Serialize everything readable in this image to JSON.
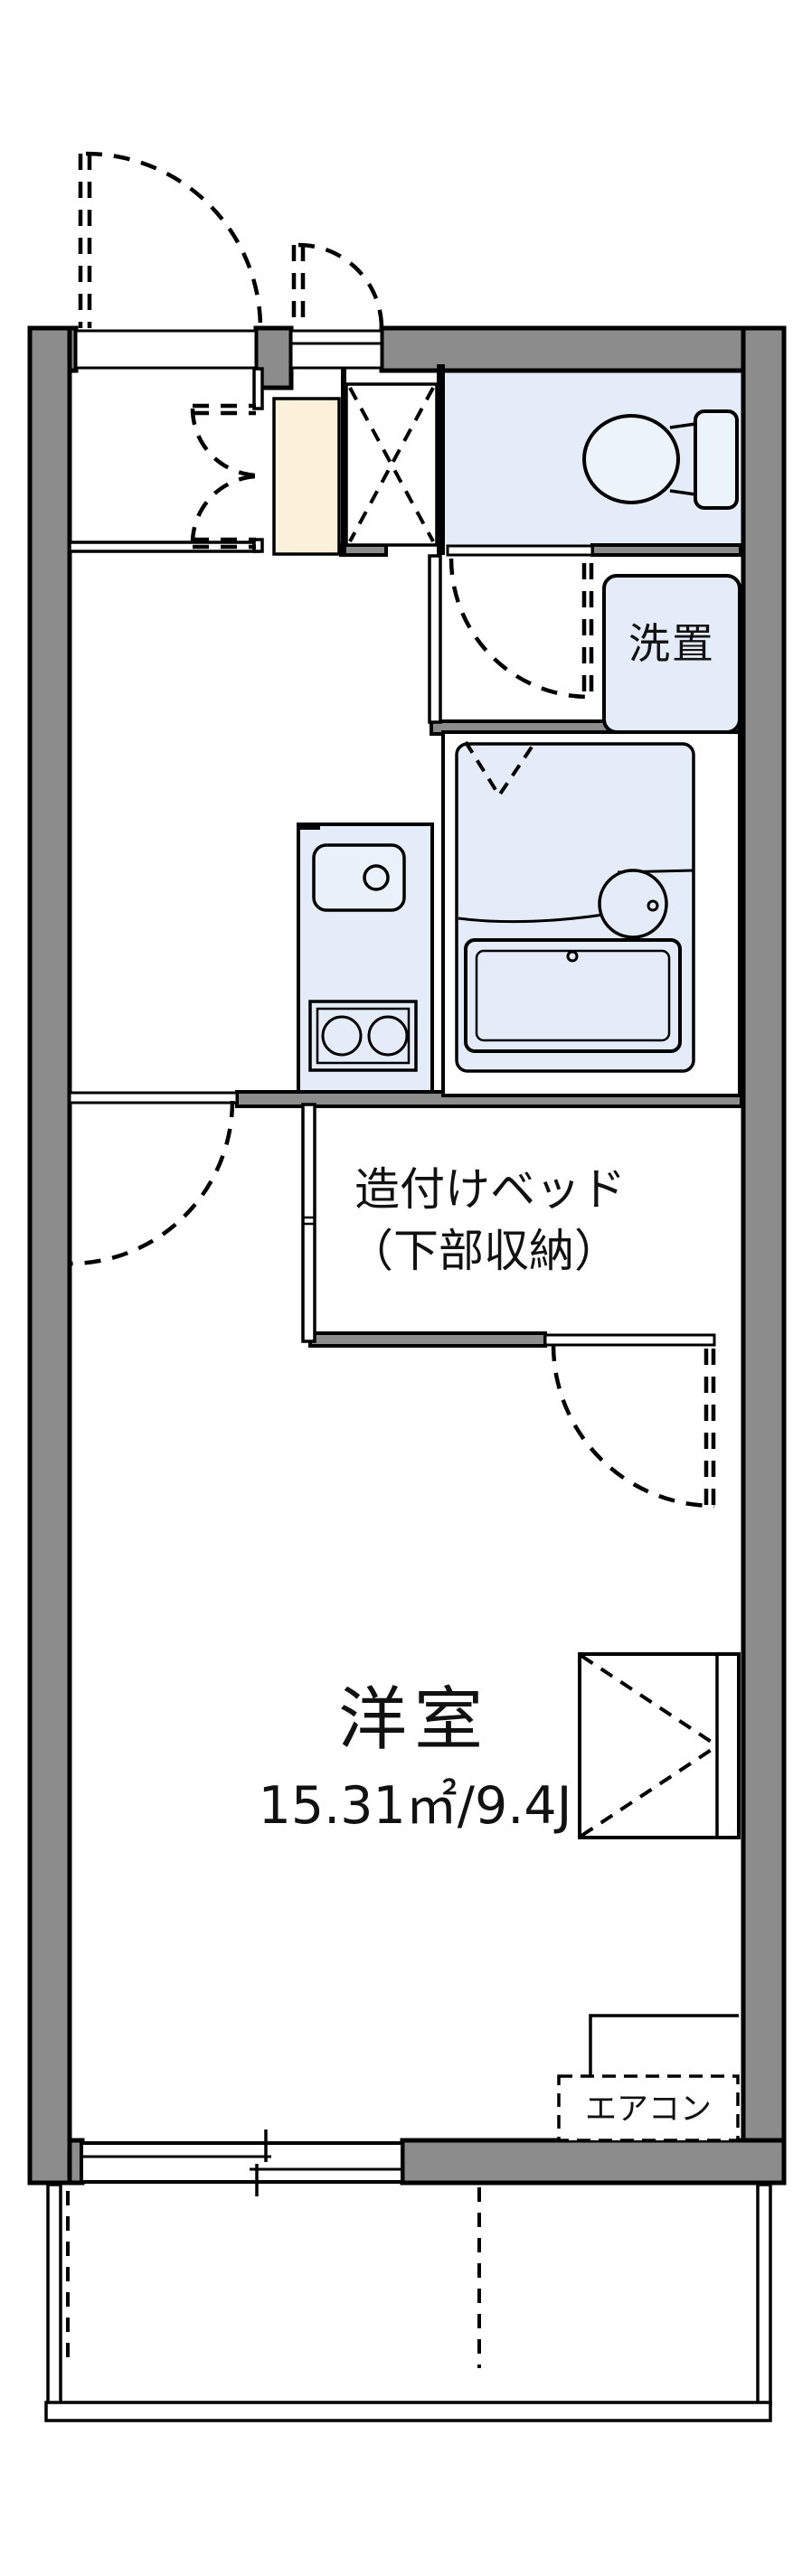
{
  "floorplan": {
    "labels": {
      "laundry": "洗置",
      "bed_line1": "造付けベッド",
      "bed_line2": "（下部収納）",
      "room_name": "洋室",
      "room_area": "15.31㎡/9.4J",
      "aircon": "エアコン"
    },
    "colors": {
      "wall_gray": "#8c8c8c",
      "fixture_blue": "#e3ecf8",
      "genkan_cream": "#fbf1da",
      "line_black": "#000000",
      "background": "#ffffff"
    }
  }
}
